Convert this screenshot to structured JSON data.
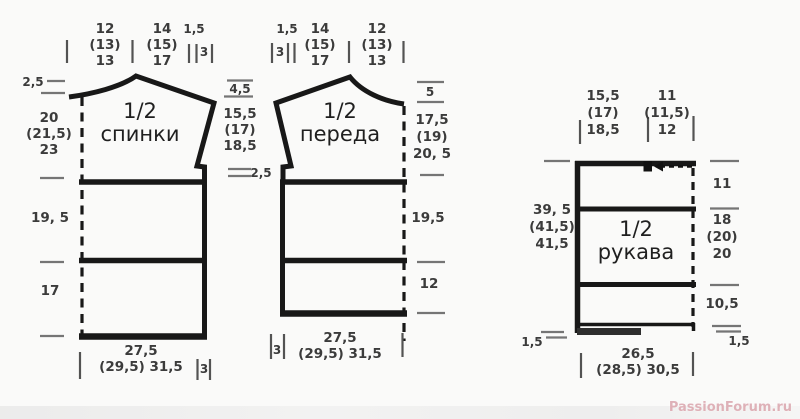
{
  "watermark": "PassionForum.ru",
  "back": {
    "title": "1/2\nспинки",
    "top": {
      "width_neck": "12\n(13)\n13",
      "width_shoulder": "14\n(15)\n17",
      "raise": "1,5",
      "slope": "3"
    },
    "left": {
      "neck_depth": "2,5",
      "armhole": "20\n(21,5)\n23",
      "mid": "19, 5",
      "lower": "17"
    },
    "bottom": {
      "width": "27,5\n(29,5)  31,5",
      "vent": "3"
    }
  },
  "middle": {
    "shoulder_drop": "4,5",
    "armhole_depth": "15,5\n(17)\n18,5",
    "step": "2,5"
  },
  "front": {
    "title": "1/2\nпереда",
    "top": {
      "raise": "1,5",
      "slope": "3",
      "width_shoulder": "14\n(15)\n17",
      "width_neck": "12\n(13)\n13"
    },
    "right": {
      "neck_depth": "5",
      "armhole": "17,5\n(19)\n20, 5",
      "mid": "19,5",
      "lower": "12"
    },
    "bottom": {
      "vent": "3",
      "width": "27,5\n(29,5)  31,5"
    }
  },
  "sleeve": {
    "title": "1/2\nрукава",
    "top": {
      "inner": "15,5\n(17)\n18,5",
      "outer": "11\n(11,5)\n12"
    },
    "left": {
      "length": "39, 5\n(41,5)\n41,5",
      "hem": "1,5"
    },
    "right": {
      "cap": "11",
      "upper": "18\n(20)\n20",
      "lower": "10,5",
      "hem": "1,5"
    },
    "bottom": {
      "width": "26,5\n(28,5)  30,5"
    }
  }
}
